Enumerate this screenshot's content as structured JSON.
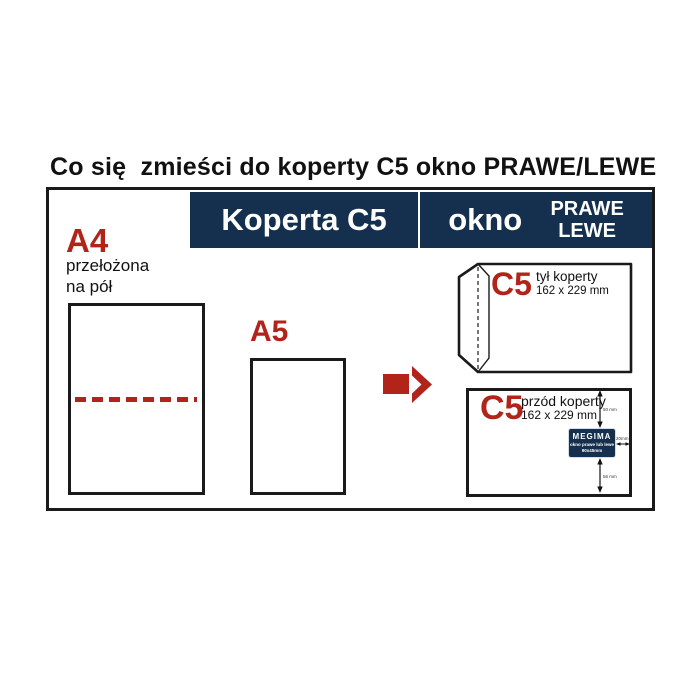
{
  "page": {
    "title": "Co się  zmieści do koperty C5 okno PRAWE/LEWE"
  },
  "header_bar": {
    "product": "Koperta C5",
    "window_word": "okno",
    "window_type_line1": "PRAWE",
    "window_type_line2": "LEWE"
  },
  "a4_sheet": {
    "label": "A4",
    "note_line1": "przełożona",
    "note_line2": "na pół"
  },
  "a5_sheet": {
    "label": "A5"
  },
  "envelope_back": {
    "format": "C5",
    "side": "tył koperty",
    "size": "162 x 229 mm"
  },
  "envelope_front": {
    "format": "C5",
    "side": "przód koperty",
    "size": "162 x 229 mm",
    "window_sticker": {
      "brand": "MEGIMA",
      "caption": "okno prawe lub lewe",
      "size": "90x45mm"
    },
    "dimensions": {
      "top": "50 mm",
      "bottom": "56 mm",
      "right": "20mm"
    }
  },
  "colors": {
    "accent_red": "#b2241a",
    "navy": "#14304e",
    "outline": "#1a1a1a"
  }
}
